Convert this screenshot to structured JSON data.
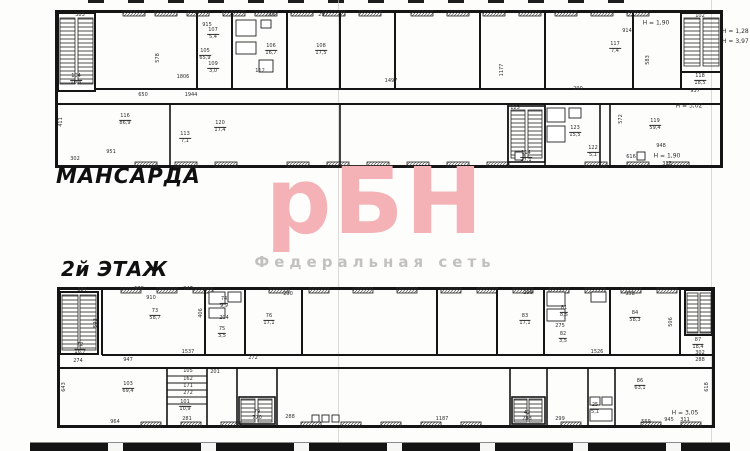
{
  "watermark": {
    "logo": "рБН",
    "subtitle": "Федеральная сеть",
    "logo_color": "#f4b2b6",
    "subtitle_color": "#c2c1bf"
  },
  "side_note": {
    "line1": "Н = 1,28",
    "line2": "Н = 3,97"
  },
  "plans": [
    {
      "title": "МАНСАРДА",
      "labels": [
        {
          "t": "383",
          "x": 25,
          "y": 6
        },
        {
          "t": "915",
          "x": 152,
          "y": 16
        },
        {
          "t": "578",
          "x": 104,
          "y": 48,
          "v": true
        },
        {
          "t": "105\n65,9",
          "x": 150,
          "y": 45
        },
        {
          "t": "299",
          "x": 215,
          "y": 6
        },
        {
          "t": "107\n5,4",
          "x": 158,
          "y": 24
        },
        {
          "t": "106\n16,7",
          "x": 216,
          "y": 40
        },
        {
          "t": "297",
          "x": 268,
          "y": 6
        },
        {
          "t": "108\n17,5",
          "x": 266,
          "y": 40
        },
        {
          "t": "109\n3,0",
          "x": 158,
          "y": 58
        },
        {
          "t": "112",
          "x": 205,
          "y": 62
        },
        {
          "t": "104\n10,4",
          "x": 21,
          "y": 70
        },
        {
          "t": "1806",
          "x": 128,
          "y": 68
        },
        {
          "t": "650",
          "x": 88,
          "y": 86
        },
        {
          "t": "1944",
          "x": 136,
          "y": 86
        },
        {
          "t": "1497",
          "x": 336,
          "y": 72
        },
        {
          "t": "Н = 1,90",
          "x": 601,
          "y": 14,
          "n": true
        },
        {
          "t": "914",
          "x": 572,
          "y": 22
        },
        {
          "t": "117\n7,4",
          "x": 560,
          "y": 38
        },
        {
          "t": "583",
          "x": 594,
          "y": 50,
          "v": true
        },
        {
          "t": "102",
          "x": 645,
          "y": 7
        },
        {
          "t": "118\n18,5",
          "x": 645,
          "y": 70
        },
        {
          "t": "937",
          "x": 640,
          "y": 82
        },
        {
          "t": "Н = 3,02",
          "x": 634,
          "y": 97,
          "n": true
        },
        {
          "t": "1177",
          "x": 448,
          "y": 60,
          "v": true
        },
        {
          "t": "116\n86,9",
          "x": 70,
          "y": 110
        },
        {
          "t": "411",
          "x": 7,
          "y": 112,
          "v": true
        },
        {
          "t": "120\n17,4",
          "x": 165,
          "y": 117
        },
        {
          "t": "113\n7,1",
          "x": 130,
          "y": 128
        },
        {
          "t": "951",
          "x": 56,
          "y": 143
        },
        {
          "t": "302",
          "x": 20,
          "y": 150
        },
        {
          "t": "125",
          "x": 460,
          "y": 99
        },
        {
          "t": "114\n27,1",
          "x": 471,
          "y": 147
        },
        {
          "t": "290",
          "x": 523,
          "y": 80
        },
        {
          "t": "123\n15,5",
          "x": 520,
          "y": 122
        },
        {
          "t": "122\n5,1",
          "x": 538,
          "y": 142
        },
        {
          "t": "572",
          "x": 567,
          "y": 109,
          "v": true
        },
        {
          "t": "119\n59,4",
          "x": 600,
          "y": 115
        },
        {
          "t": "948",
          "x": 606,
          "y": 137
        },
        {
          "t": "616",
          "x": 576,
          "y": 148
        },
        {
          "t": "Н = 1,90",
          "x": 612,
          "y": 147,
          "n": true
        },
        {
          "t": "313",
          "x": 612,
          "y": 155
        }
      ]
    },
    {
      "title": "2й ЭТАЖ",
      "labels": [
        {
          "t": "384",
          "x": 25,
          "y": 4
        },
        {
          "t": "573",
          "x": 82,
          "y": 3
        },
        {
          "t": "247",
          "x": 131,
          "y": 3
        },
        {
          "t": "910",
          "x": 94,
          "y": 12
        },
        {
          "t": "73\n58,7",
          "x": 98,
          "y": 28
        },
        {
          "t": "593",
          "x": 40,
          "y": 36,
          "v": true
        },
        {
          "t": "72\n16,7",
          "x": 23,
          "y": 62
        },
        {
          "t": "274",
          "x": 21,
          "y": 75
        },
        {
          "t": "947",
          "x": 71,
          "y": 74
        },
        {
          "t": "1537",
          "x": 131,
          "y": 66
        },
        {
          "t": "406",
          "x": 145,
          "y": 26,
          "v": true
        },
        {
          "t": "74\n9,9",
          "x": 167,
          "y": 16
        },
        {
          "t": "204",
          "x": 167,
          "y": 32
        },
        {
          "t": "75\n3,5",
          "x": 165,
          "y": 46
        },
        {
          "t": "76\n17,1",
          "x": 212,
          "y": 33
        },
        {
          "t": "290",
          "x": 231,
          "y": 8
        },
        {
          "t": "272",
          "x": 196,
          "y": 72
        },
        {
          "t": "296",
          "x": 471,
          "y": 7
        },
        {
          "t": "83\n17,1",
          "x": 468,
          "y": 33
        },
        {
          "t": "81\n8,5",
          "x": 507,
          "y": 25
        },
        {
          "t": "275",
          "x": 503,
          "y": 40
        },
        {
          "t": "82\n3,5",
          "x": 506,
          "y": 51
        },
        {
          "t": "1526",
          "x": 540,
          "y": 66
        },
        {
          "t": "958",
          "x": 573,
          "y": 8
        },
        {
          "t": "84\n58,3",
          "x": 578,
          "y": 30
        },
        {
          "t": "506",
          "x": 615,
          "y": 35,
          "v": true
        },
        {
          "t": "87\n18,4",
          "x": 641,
          "y": 57
        },
        {
          "t": "302",
          "x": 643,
          "y": 67
        },
        {
          "t": "288",
          "x": 643,
          "y": 74
        },
        {
          "t": "103\n69,4",
          "x": 71,
          "y": 101
        },
        {
          "t": "643",
          "x": 8,
          "y": 100,
          "v": true
        },
        {
          "t": "964",
          "x": 58,
          "y": 136
        },
        {
          "t": "105",
          "x": 131,
          "y": 85
        },
        {
          "t": "162",
          "x": 131,
          "y": 93
        },
        {
          "t": "171",
          "x": 131,
          "y": 100
        },
        {
          "t": "272",
          "x": 131,
          "y": 107
        },
        {
          "t": "101\n10,9",
          "x": 128,
          "y": 119
        },
        {
          "t": "281",
          "x": 130,
          "y": 133
        },
        {
          "t": "201",
          "x": 158,
          "y": 86
        },
        {
          "t": "79",
          "x": 200,
          "y": 126
        },
        {
          "t": "770",
          "x": 200,
          "y": 132
        },
        {
          "t": "288",
          "x": 233,
          "y": 131
        },
        {
          "t": "1187",
          "x": 385,
          "y": 133
        },
        {
          "t": "42",
          "x": 470,
          "y": 127
        },
        {
          "t": "283",
          "x": 470,
          "y": 133
        },
        {
          "t": "299",
          "x": 503,
          "y": 133
        },
        {
          "t": "25\n5,1",
          "x": 538,
          "y": 122
        },
        {
          "t": "86\n63,1",
          "x": 583,
          "y": 98
        },
        {
          "t": "569",
          "x": 589,
          "y": 136
        },
        {
          "t": "945",
          "x": 612,
          "y": 134
        },
        {
          "t": "Н = 3,05",
          "x": 628,
          "y": 127,
          "n": true
        },
        {
          "t": "311",
          "x": 628,
          "y": 134
        },
        {
          "t": "618",
          "x": 651,
          "y": 100,
          "v": true
        }
      ]
    }
  ]
}
